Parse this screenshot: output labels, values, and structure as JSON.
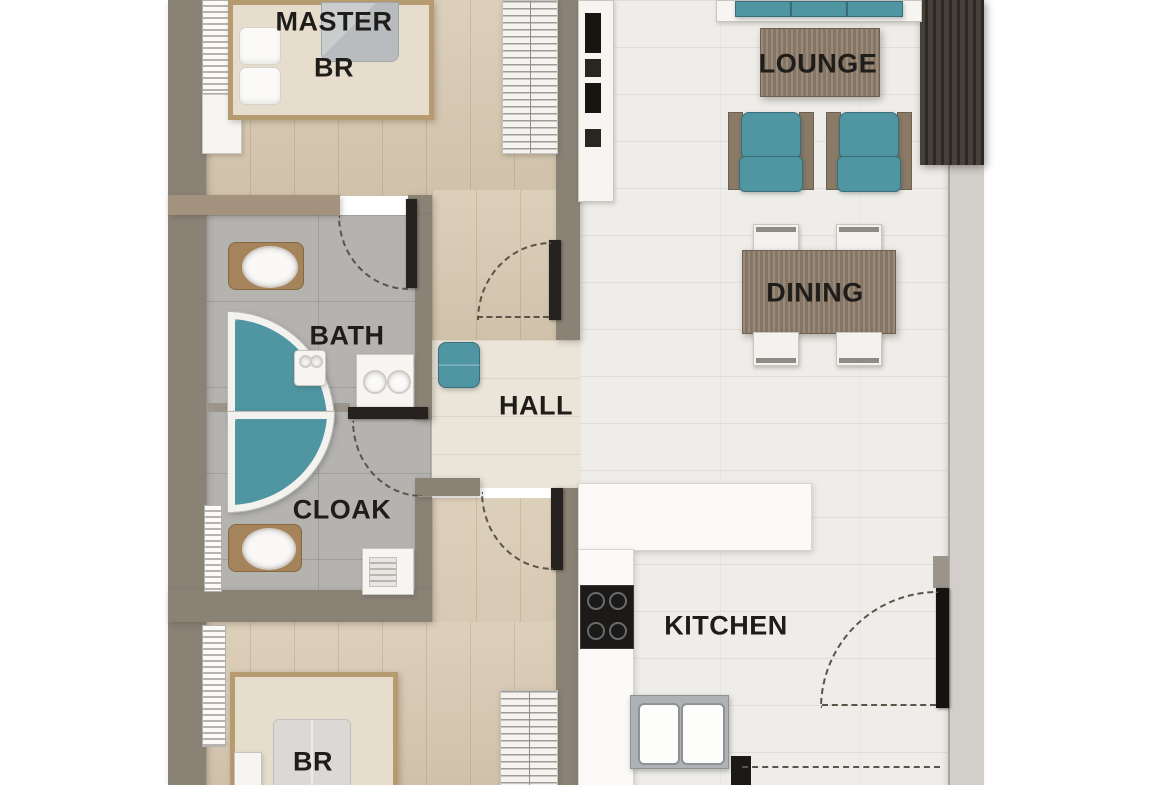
{
  "colors": {
    "teal": "#4f96a2",
    "wood_furniture": "#8f7e6c",
    "wood_frame": "#b79b70",
    "wall_gray": "#8b8276",
    "wall_taupe": "#a3927e",
    "wall_light": "#d2cfca",
    "wall_dark": "#262220",
    "floor_wood_beige": "#d8c9b1",
    "floor_hall": "#eae4d9",
    "floor_tile_white": "#efede9",
    "floor_tile_gray": "#b5b3b0",
    "fixture_white": "#f6f5f2",
    "quilt_gray": "#b9bcbe",
    "label_color": "#1f1d1a"
  },
  "rooms": {
    "master_br": {
      "line1": "MASTER",
      "line2": "BR"
    },
    "lounge": {
      "label": "LOUNGE"
    },
    "dining": {
      "label": "DINING"
    },
    "bath": {
      "label": "BATH"
    },
    "hall": {
      "label": "HALL"
    },
    "cloak": {
      "label": "CLOAK"
    },
    "kitchen": {
      "label": "KITCHEN"
    },
    "bedroom2": {
      "label": "BR"
    }
  }
}
